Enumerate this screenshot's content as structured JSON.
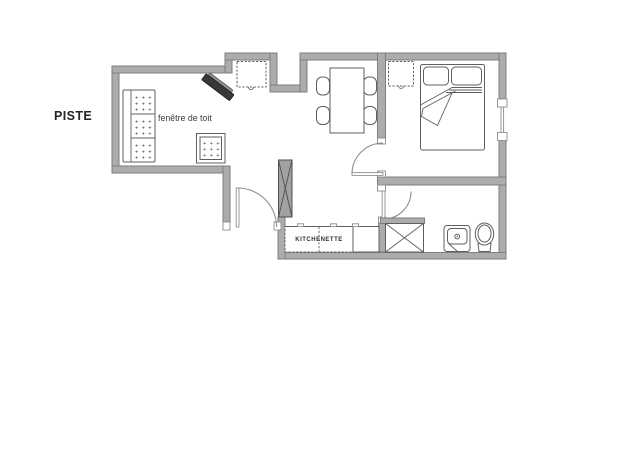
{
  "page": {
    "width": 640,
    "height": 452,
    "background": "#ffffff",
    "type": "apartment floor plan"
  },
  "labels": {
    "area_left": "PISTE",
    "roof_window": "fenêtre de toit",
    "kitchenette": "KITCHENETTE"
  },
  "decor": {
    "plus_row": "+ + +"
  },
  "colors": {
    "floor": "#ffffff",
    "wall_fill": "#acacac",
    "wall_stroke": "#7e7e7e",
    "furniture_stroke": "#5f5f5f",
    "closet_fill": "#a2a2a2",
    "tv_fill": "#383838",
    "label_dark": "#23232b",
    "label_gray": "#3c3c3c"
  },
  "plan": {
    "rooms": [
      {
        "name": "living-dining",
        "items": [
          "sofa",
          "pouf",
          "tv",
          "roof-window",
          "dining-table",
          "chairs-x4",
          "kitchenette-counter"
        ]
      },
      {
        "name": "bedroom",
        "items": [
          "double-bed",
          "pillows-x2",
          "roof-window",
          "window"
        ]
      },
      {
        "name": "bathroom",
        "items": [
          "shower",
          "washbasin",
          "toilet"
        ]
      },
      {
        "name": "entry",
        "items": [
          "entrance-door",
          "closet"
        ]
      }
    ],
    "doors": [
      "entrance-door",
      "bedroom-door",
      "bathroom-door"
    ],
    "windows": [
      "roof-window-living",
      "roof-window-bedroom",
      "bedroom-side-window"
    ]
  }
}
